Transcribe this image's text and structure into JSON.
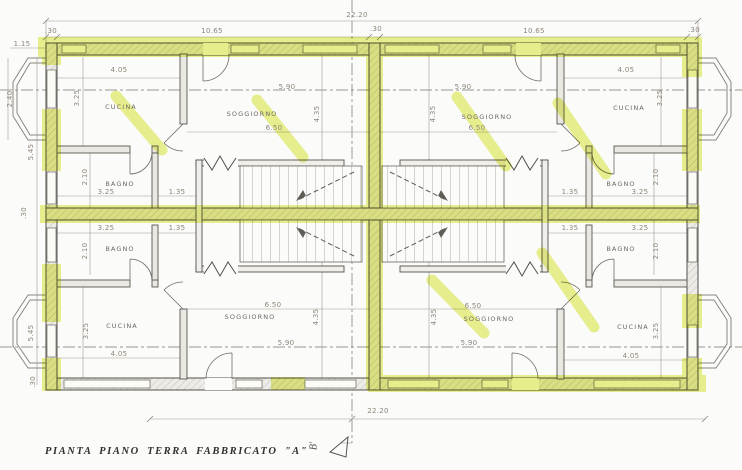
{
  "caption": "PIANTA PIANO TERRA FABBRICATO \"A\"",
  "section_marker": {
    "label": "B'"
  },
  "colors": {
    "paper": "#fbfbf9",
    "highlight": "#dde94c",
    "dim_text": "#8d867a",
    "room_text": "#6e6961",
    "caption_text": "#33312d"
  },
  "rooms": [
    {
      "id": "cucina-top-left",
      "label": "CUCINA",
      "x": 121,
      "y": 107
    },
    {
      "id": "soggiorno-top-left",
      "label": "SOGGIORNO",
      "x": 252,
      "y": 114
    },
    {
      "id": "soggiorno-top-right",
      "label": "SOGGIORNO",
      "x": 487,
      "y": 117
    },
    {
      "id": "cucina-top-right",
      "label": "CUCINA",
      "x": 629,
      "y": 108
    },
    {
      "id": "bagno-mid-left-upper",
      "label": "BAGNO",
      "x": 120,
      "y": 184
    },
    {
      "id": "bagno-mid-right-upper",
      "label": "BAGNO",
      "x": 621,
      "y": 184
    },
    {
      "id": "bagno-mid-left-lower",
      "label": "BAGNO",
      "x": 120,
      "y": 249
    },
    {
      "id": "bagno-mid-right-lower",
      "label": "BAGNO",
      "x": 621,
      "y": 249
    },
    {
      "id": "cucina-bottom-left",
      "label": "CUCINA",
      "x": 122,
      "y": 326
    },
    {
      "id": "soggiorno-bottom-left",
      "label": "SOGGIORNO",
      "x": 250,
      "y": 317
    },
    {
      "id": "soggiorno-bottom-right",
      "label": "SOGGIORNO",
      "x": 489,
      "y": 319
    },
    {
      "id": "cucina-bottom-right",
      "label": "CUCINA",
      "x": 633,
      "y": 327
    }
  ],
  "dimensions": [
    {
      "text": "22.20",
      "x": 357,
      "y": 15
    },
    {
      "text": ".30",
      "x": 376,
      "y": 29
    },
    {
      "text": ".30",
      "x": 51,
      "y": 31
    },
    {
      "text": "10.65",
      "x": 212,
      "y": 31
    },
    {
      "text": "10.65",
      "x": 534,
      "y": 31
    },
    {
      "text": ".30",
      "x": 694,
      "y": 30
    },
    {
      "text": "1.15",
      "x": 22,
      "y": 44
    },
    {
      "text": "4.05",
      "x": 119,
      "y": 70
    },
    {
      "text": "4.05",
      "x": 626,
      "y": 70
    },
    {
      "text": "5.90",
      "x": 287,
      "y": 87
    },
    {
      "text": "5.90",
      "x": 463,
      "y": 87
    },
    {
      "text": "6.50",
      "x": 274,
      "y": 128
    },
    {
      "text": "6.50",
      "x": 477,
      "y": 128
    },
    {
      "text": "4.35",
      "x": 317,
      "y": 114,
      "rot": -90
    },
    {
      "text": "4.35",
      "x": 433,
      "y": 114,
      "rot": -90
    },
    {
      "text": "3.25",
      "x": 77,
      "y": 98,
      "rot": -90
    },
    {
      "text": "3.25",
      "x": 660,
      "y": 98,
      "rot": -90
    },
    {
      "text": "2.40",
      "x": 10,
      "y": 99,
      "rot": -90
    },
    {
      "text": "5.45",
      "x": 31,
      "y": 152,
      "rot": -90
    },
    {
      "text": "2.10",
      "x": 85,
      "y": 177,
      "rot": -90
    },
    {
      "text": "2.10",
      "x": 656,
      "y": 177,
      "rot": -90
    },
    {
      "text": "3.25",
      "x": 106,
      "y": 192
    },
    {
      "text": "1.35",
      "x": 177,
      "y": 192
    },
    {
      "text": "1.35",
      "x": 570,
      "y": 192
    },
    {
      "text": "3.25",
      "x": 640,
      "y": 192
    },
    {
      "text": ".30",
      "x": 24,
      "y": 213,
      "rot": -90
    },
    {
      "text": "3.25",
      "x": 106,
      "y": 228
    },
    {
      "text": "1.35",
      "x": 177,
      "y": 228
    },
    {
      "text": "1.35",
      "x": 570,
      "y": 228
    },
    {
      "text": "3.25",
      "x": 640,
      "y": 228
    },
    {
      "text": "2.10",
      "x": 85,
      "y": 251,
      "rot": -90
    },
    {
      "text": "2.10",
      "x": 656,
      "y": 251,
      "rot": -90
    },
    {
      "text": "5.45",
      "x": 31,
      "y": 333,
      "rot": -90
    },
    {
      "text": "3.25",
      "x": 86,
      "y": 331,
      "rot": -90
    },
    {
      "text": "3.25",
      "x": 656,
      "y": 331,
      "rot": -90
    },
    {
      "text": "6.50",
      "x": 273,
      "y": 305
    },
    {
      "text": "6.50",
      "x": 473,
      "y": 306
    },
    {
      "text": "4.35",
      "x": 316,
      "y": 317,
      "rot": -90
    },
    {
      "text": "4.35",
      "x": 434,
      "y": 317,
      "rot": -90
    },
    {
      "text": "5.90",
      "x": 286,
      "y": 343
    },
    {
      "text": "5.90",
      "x": 469,
      "y": 343
    },
    {
      "text": "4.05",
      "x": 119,
      "y": 354
    },
    {
      "text": "4.05",
      "x": 631,
      "y": 356
    },
    {
      "text": ".30",
      "x": 33,
      "y": 382,
      "rot": -90
    },
    {
      "text": "22.20",
      "x": 378,
      "y": 411
    }
  ]
}
